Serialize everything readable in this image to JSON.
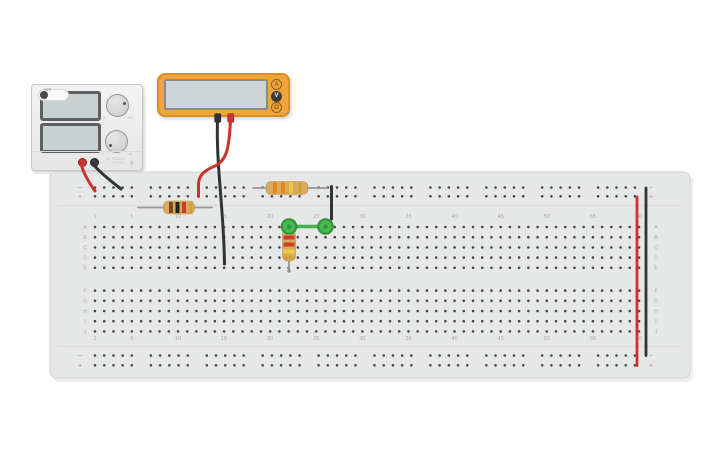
{
  "canvas": {
    "background": "#ffffff"
  },
  "power_supply": {
    "display_top_value": "",
    "display_bottom_value": "",
    "voltage_knob": {
      "min_label": "0",
      "max_label": "30V"
    },
    "current_knob": {
      "min_label": "0",
      "max_label": "1A"
    },
    "off_label": "OFF",
    "brand_line1": "DC POWER",
    "brand_line2": "SUPPLY"
  },
  "multimeter": {
    "display_value": "",
    "mode_buttons": [
      {
        "label": "A",
        "active": false
      },
      {
        "label": "V",
        "active": true
      },
      {
        "label": "Ω",
        "active": false
      }
    ]
  },
  "breadboard": {
    "column_numbers": [
      "1",
      "5",
      "10",
      "15",
      "20",
      "25",
      "30",
      "35",
      "40",
      "45",
      "50",
      "55",
      "60"
    ],
    "column_number_positions": [
      1,
      5,
      10,
      15,
      20,
      25,
      30,
      35,
      40,
      45,
      50,
      55,
      60
    ],
    "row_letters_upper": [
      "A",
      "B",
      "C",
      "D",
      "E"
    ],
    "row_letters_lower": [
      "F",
      "G",
      "H",
      "I",
      "J"
    ],
    "minus_symbol": "−",
    "plus_symbol": "+"
  },
  "components": {
    "resistors": [
      {
        "id": "resistor-1",
        "orientation": "horizontal",
        "band_colors": [
          "brown",
          "black",
          "red",
          "gold"
        ]
      },
      {
        "id": "resistor-2",
        "orientation": "horizontal",
        "band_colors": [
          "orange",
          "orange",
          "yellow",
          "gold"
        ]
      },
      {
        "id": "resistor-3",
        "orientation": "vertical",
        "band_colors": [
          "red",
          "red",
          "yellow",
          "gold"
        ]
      }
    ],
    "wires": [
      {
        "id": "psu-red-lead",
        "color": "red"
      },
      {
        "id": "psu-black-lead",
        "color": "black"
      },
      {
        "id": "short-black-jumper",
        "color": "black"
      },
      {
        "id": "green-jumper",
        "color": "green"
      },
      {
        "id": "right-red-jumper",
        "color": "red"
      },
      {
        "id": "right-black-jumper",
        "color": "black"
      },
      {
        "id": "multimeter-black-probe",
        "color": "black"
      },
      {
        "id": "multimeter-red-probe",
        "color": "red"
      }
    ]
  },
  "colors": {
    "wire": {
      "red": "#c9342d",
      "black": "#303439",
      "green": "#43b14b"
    },
    "bands": {
      "brown": "#7a4a21",
      "black": "#222222",
      "red": "#d03a2a",
      "orange": "#e2871e",
      "yellow": "#eccb3f",
      "gold": "#c9a23f"
    },
    "resistor_body": "#d9a95f",
    "board_fill": "#e6e7e7",
    "hole": "#474747",
    "label": "#a6a6a6",
    "rail_minus": "#7fb2d9",
    "rail_plus": "#e08a8a",
    "green_terminal_fill": "#4db852",
    "green_terminal_stroke": "#2f9539"
  }
}
